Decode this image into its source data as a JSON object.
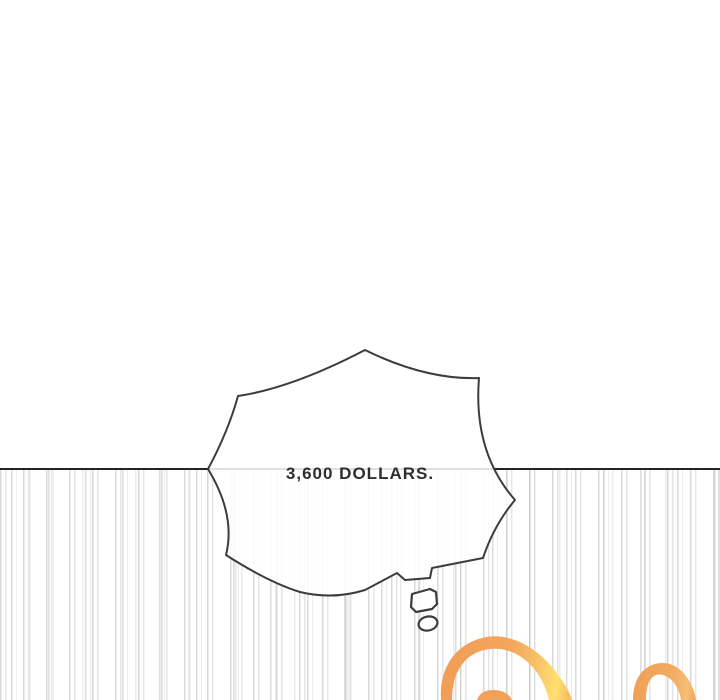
{
  "panel": {
    "kind": "comic-webtoon-panel",
    "bubble": {
      "text": "3,600 DOLLARS."
    },
    "colors": {
      "background": "#ffffff",
      "horizon_line": "#242424",
      "speed_line_gray": "#c9c9c9",
      "bubble_outline": "#3c3c3c",
      "bubble_fill": "#ffffff",
      "text": "#2e2e2e",
      "hair_orange": "#f2a158",
      "hair_yellow": "#ffe071"
    }
  }
}
